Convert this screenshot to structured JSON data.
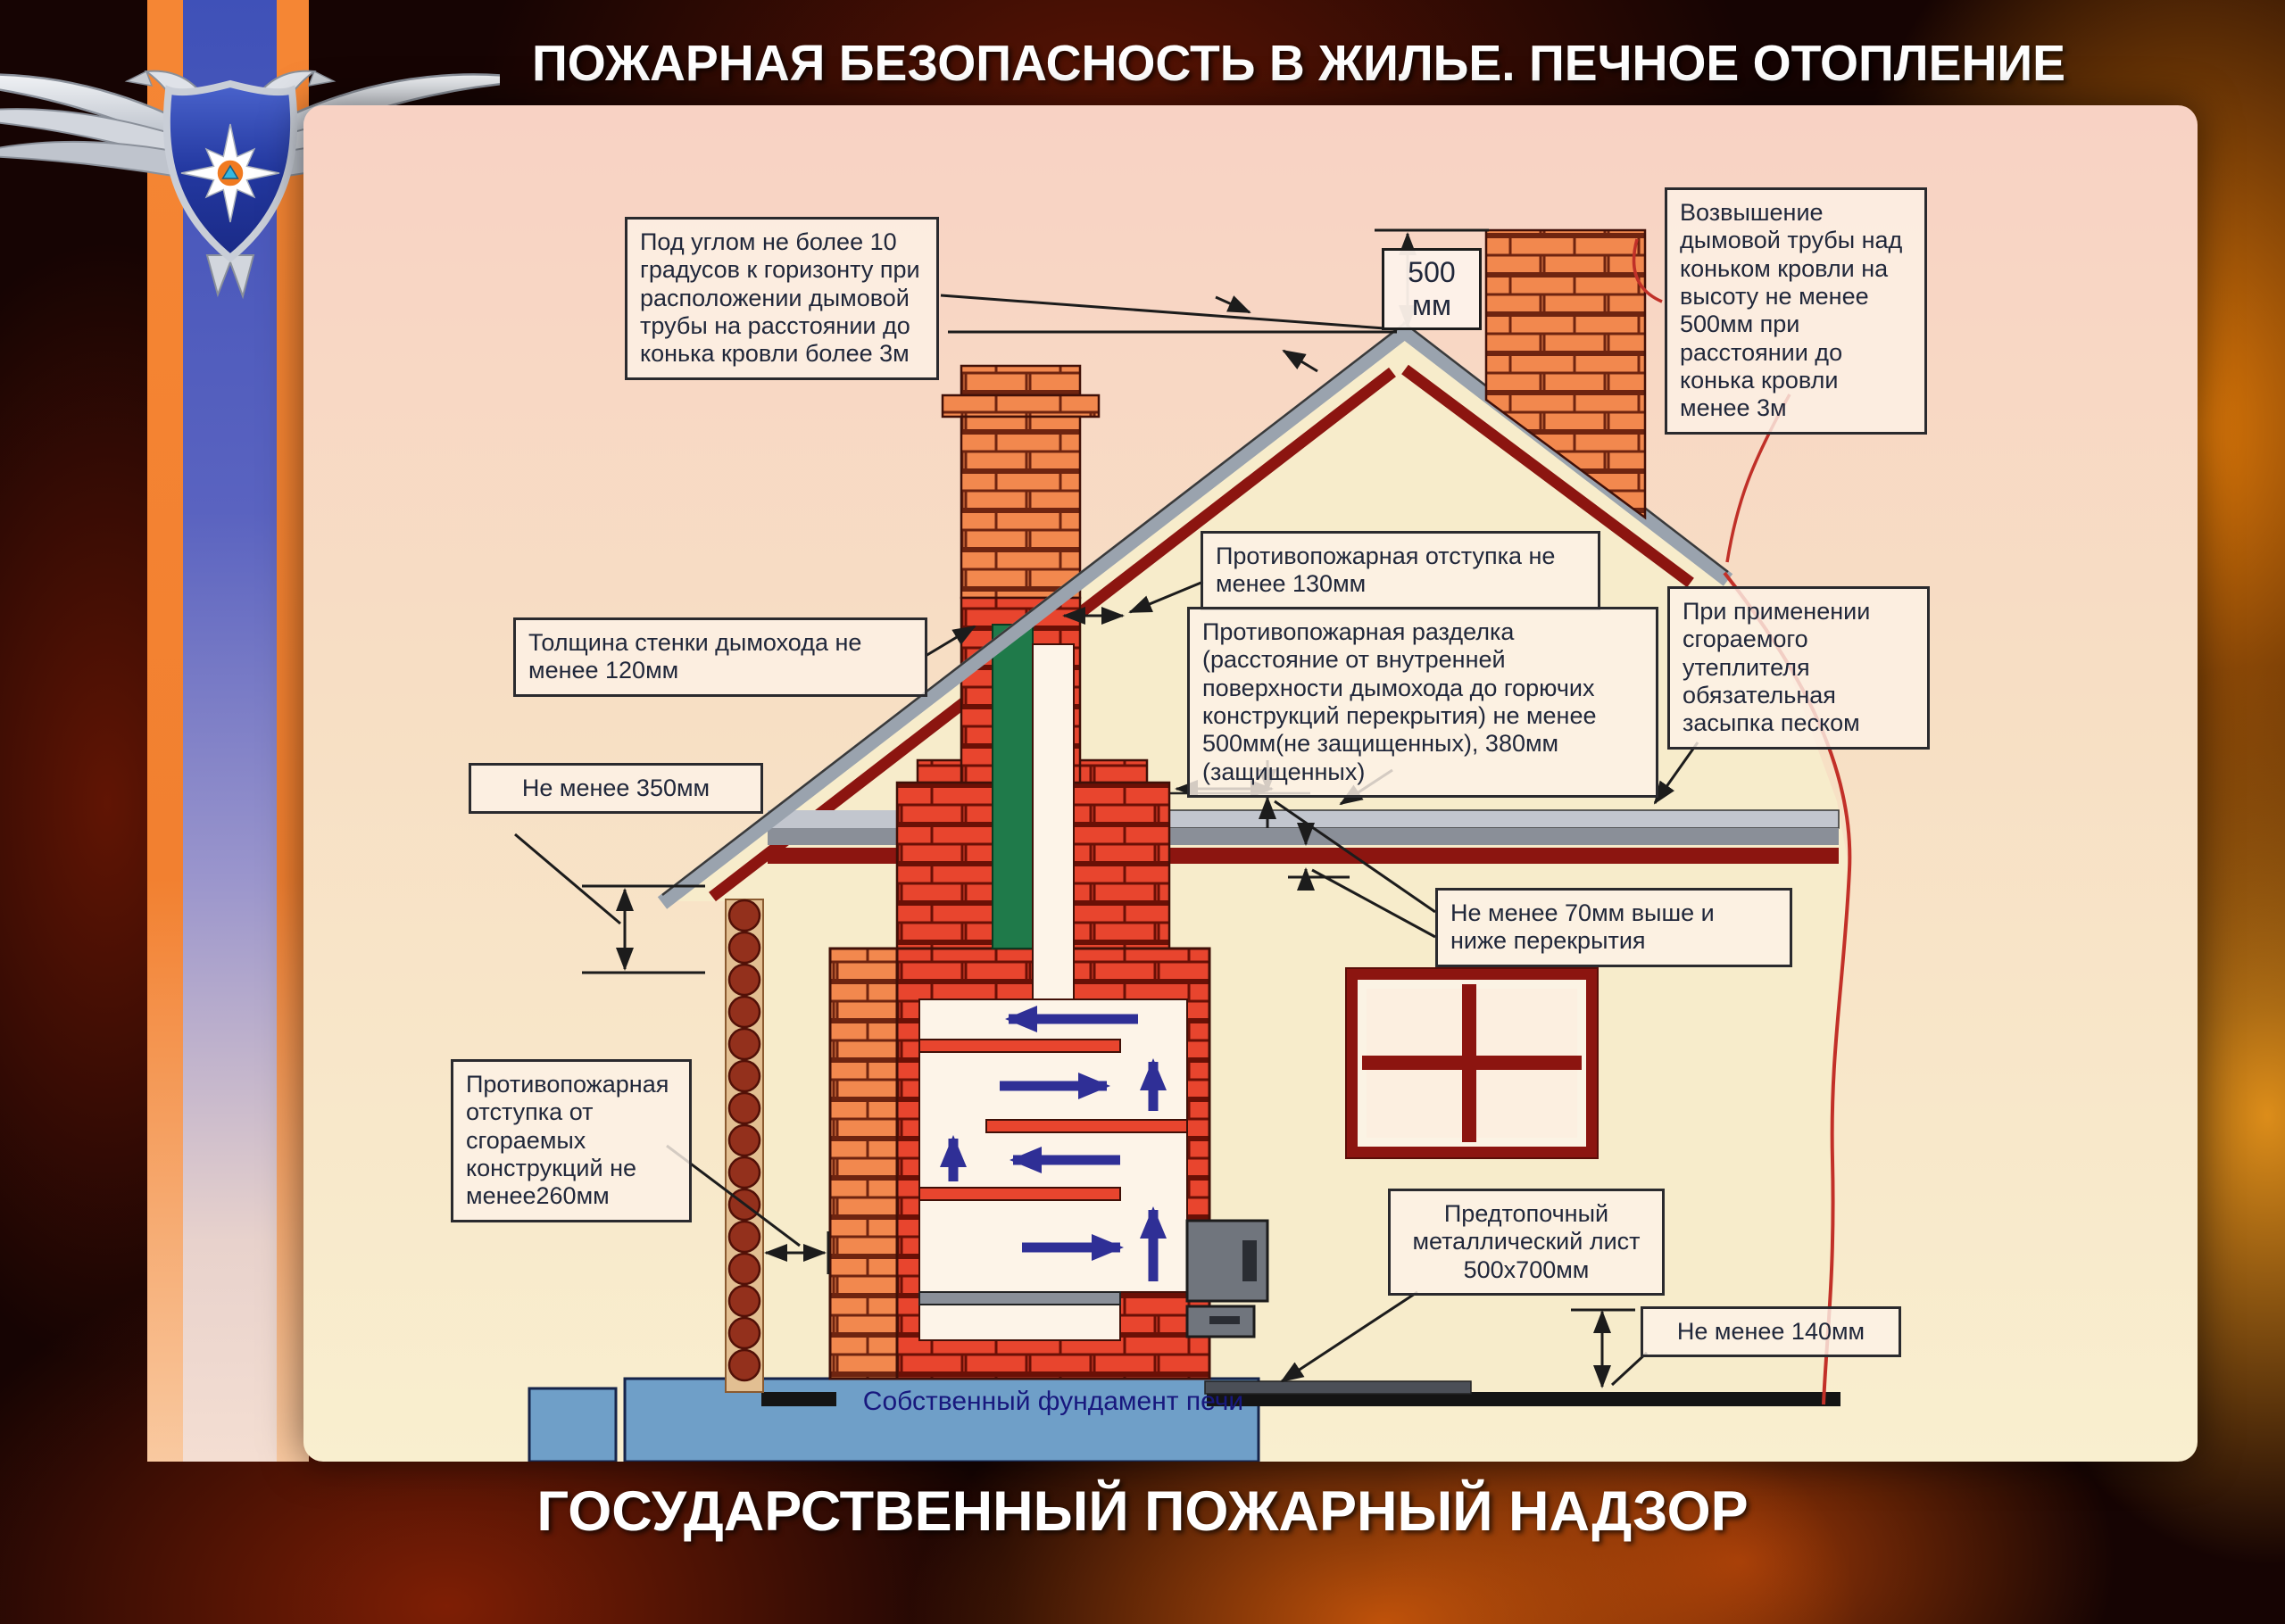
{
  "title": "ПОЖАРНАЯ БЕЗОПАСНОСТЬ В ЖИЛЬЕ. ПЕЧНОЕ ОТОПЛЕНИЕ",
  "footer": "ГОСУДАРСТВЕННЫЙ ПОЖАРНЫЙ НАДЗОР",
  "emblem": {
    "name": "mchs-russia-emblem",
    "description": "двуглавый орёл МЧС России со щитом и звездой"
  },
  "colors": {
    "poster_top": "#f8d2c4",
    "poster_bottom": "#f9efcf",
    "brick_orange": "#f2884e",
    "brick_red": "#e8452e",
    "roof_gray": "#9aa3ae",
    "roof_dark_red": "#8c1510",
    "foundation_blue": "#6f9fc8",
    "damper_green": "#1f7a4a",
    "smoke_arrow_blue": "#2f2f96",
    "stripe_orange": "#f58634",
    "stripe_blue": "#3f51b8"
  },
  "labels": {
    "angle": "Под углом не более 10 градусов к горизонту при расположении дымовой трубы на расстоянии до конька кровли более 3м",
    "elevation": "Возвышение дымовой трубы над коньком кровли на высоту не менее 500мм при расстоянии до конька кровли менее 3м",
    "dim500": "500 мм",
    "otstupka130": "Противопожарная отступка не менее 130мм",
    "razdelka": "Противопожарная разделка (расстояние от внутренней поверхности дымохода до горючих конструкций перекрытия) не менее 500мм(не защищенных), 380мм (защищенных)",
    "wall120": "Толщина стенки дымохода не менее 120мм",
    "min350": "Не менее 350мм",
    "min70": "Не менее 70мм выше и ниже перекрытия",
    "otstupka260": "Противопожарная отступка от сгораемых конструкций не менее260мм",
    "sand": "При применении сгораемого утеплителя обязательная засыпка песком",
    "sheet": "Предтопочный металлический лист 500х700мм",
    "min140": "Не менее 140мм",
    "foundation": "Собственный фундамент печи"
  }
}
